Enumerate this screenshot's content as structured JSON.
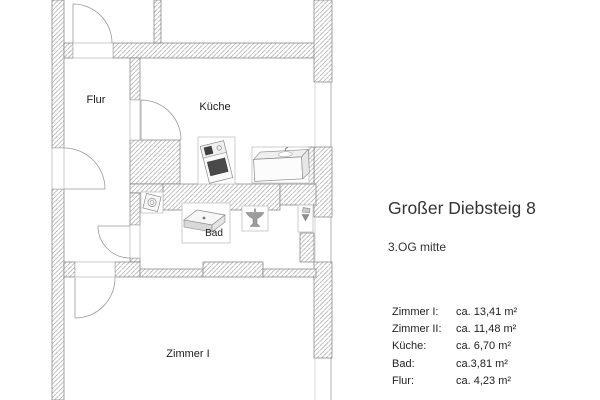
{
  "title": "Großer Diebsteig 8",
  "subtitle": "3.OG mitte",
  "rooms": [
    {
      "label": "Zimmer I:",
      "area": "ca. 13,41 m²"
    },
    {
      "label": "Zimmer II:",
      "area": "ca. 11,48 m²"
    },
    {
      "label": "Küche:",
      "area": "ca. 6,70 m²"
    },
    {
      "label": "Bad:",
      "area": "ca.3,81 m²"
    },
    {
      "label": "Flur:",
      "area": "ca. 4,23 m²"
    }
  ],
  "plan": {
    "labels": {
      "flur": "Flur",
      "kueche": "Küche",
      "bad": "Bad",
      "zimmer1": "Zimmer I"
    },
    "fixtures": [
      "stove-icon",
      "kitchen-counter-sink-icon",
      "washing-machine-icon",
      "shower-tray-icon",
      "washbasin-icon",
      "toilet-icon"
    ],
    "colors": {
      "wall_outline": "#7c7c7c",
      "wall_hatch": "#b5b5b5",
      "door_arc": "#9a9a9a",
      "fixture_dark": "#4a4a4a",
      "text": "#333333"
    }
  }
}
